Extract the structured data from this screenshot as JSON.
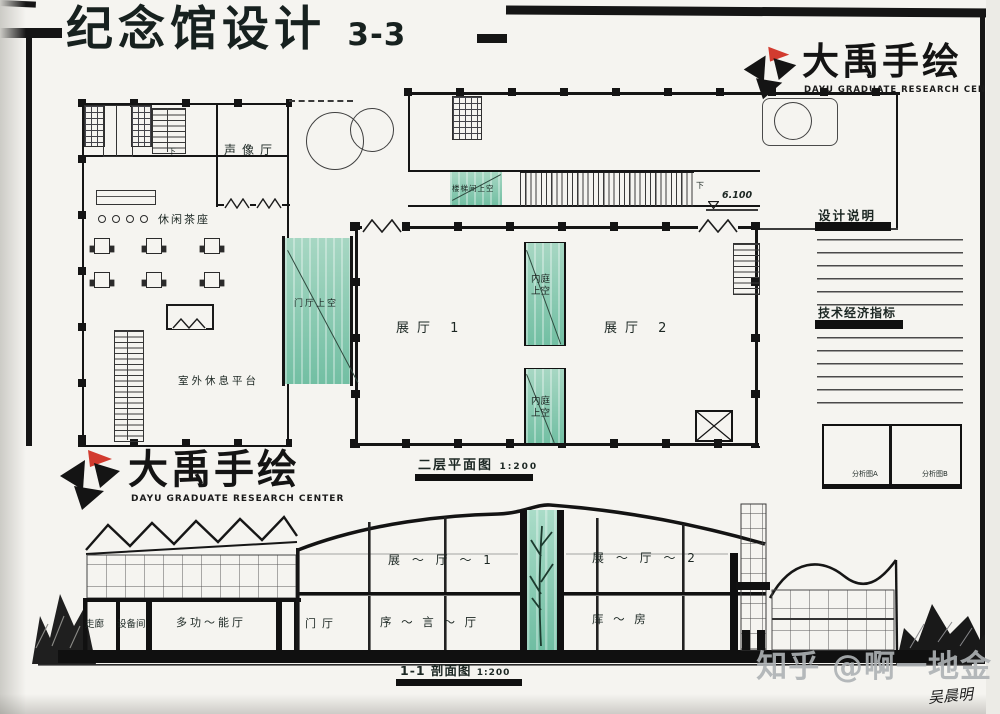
{
  "colors": {
    "ink": "#151515",
    "green": "#7fc5ab",
    "red": "#d23b2f",
    "paper": "#f5f4f0",
    "watermark": "#aeb2b5"
  },
  "title": {
    "main": "纪念馆设计",
    "suffix": "3-3"
  },
  "logo": {
    "name": "大禹手绘",
    "subtitle": "DAYU GRADUATE RESEARCH CENTER"
  },
  "plan": {
    "caption": "二层平面图",
    "scale": "1:200",
    "level_mark": "6.100",
    "down_mark": "下",
    "labels": {
      "audio_hall": "声像厅",
      "tea_lounge": "休闲茶座",
      "outdoor_platform": "室外休息平台",
      "entry_void": "门厅上空",
      "stair_void": "楼梯间上空",
      "court_void": "内庭上空",
      "exhibit_1": "展厅 1",
      "exhibit_2": "展厅 2"
    }
  },
  "notes": {
    "design_heading": "设计说明",
    "tech_heading": "技术经济指标",
    "box_a": "分析图A",
    "box_b": "分析图B"
  },
  "section": {
    "caption": "1-1 剖面图",
    "scale": "1:200",
    "labels": {
      "hall1": "展 ～ 厅 ～ 1",
      "hall2": "展 ～ 厅 ～ 2",
      "corridor": "走廊",
      "equipment": "设备间",
      "multi_hall": "多功～能厅",
      "foyer": "门厅",
      "preface": "序 ～ 言 ～ 厅",
      "storage": "库 ～ 房"
    }
  },
  "watermark": {
    "text": "知乎 @啊一地金",
    "signature": "吴晨明"
  }
}
